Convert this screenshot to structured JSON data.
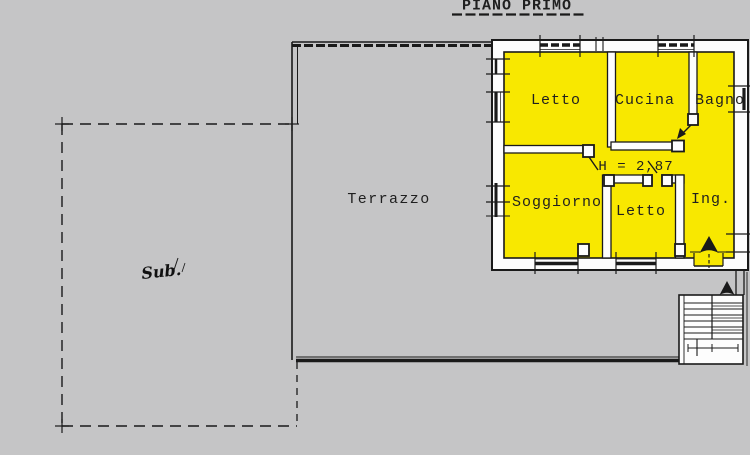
{
  "title": "PIANO PRIMO",
  "rooms": {
    "letto1": "Letto",
    "cucina": "Cucina",
    "bagno": "Bagno",
    "soggiorno": "Soggiorno",
    "letto2": "Letto",
    "ingresso": "Ing."
  },
  "annotations": {
    "ceiling_height": "H = 2,87",
    "terrace": "Terrazzo",
    "sub": "Sub."
  },
  "colors": {
    "background": "#c5c5c6",
    "apartment_fill": "#f8e800",
    "wall_fill": "#fdfdfd",
    "line": "#1a1a1a"
  }
}
